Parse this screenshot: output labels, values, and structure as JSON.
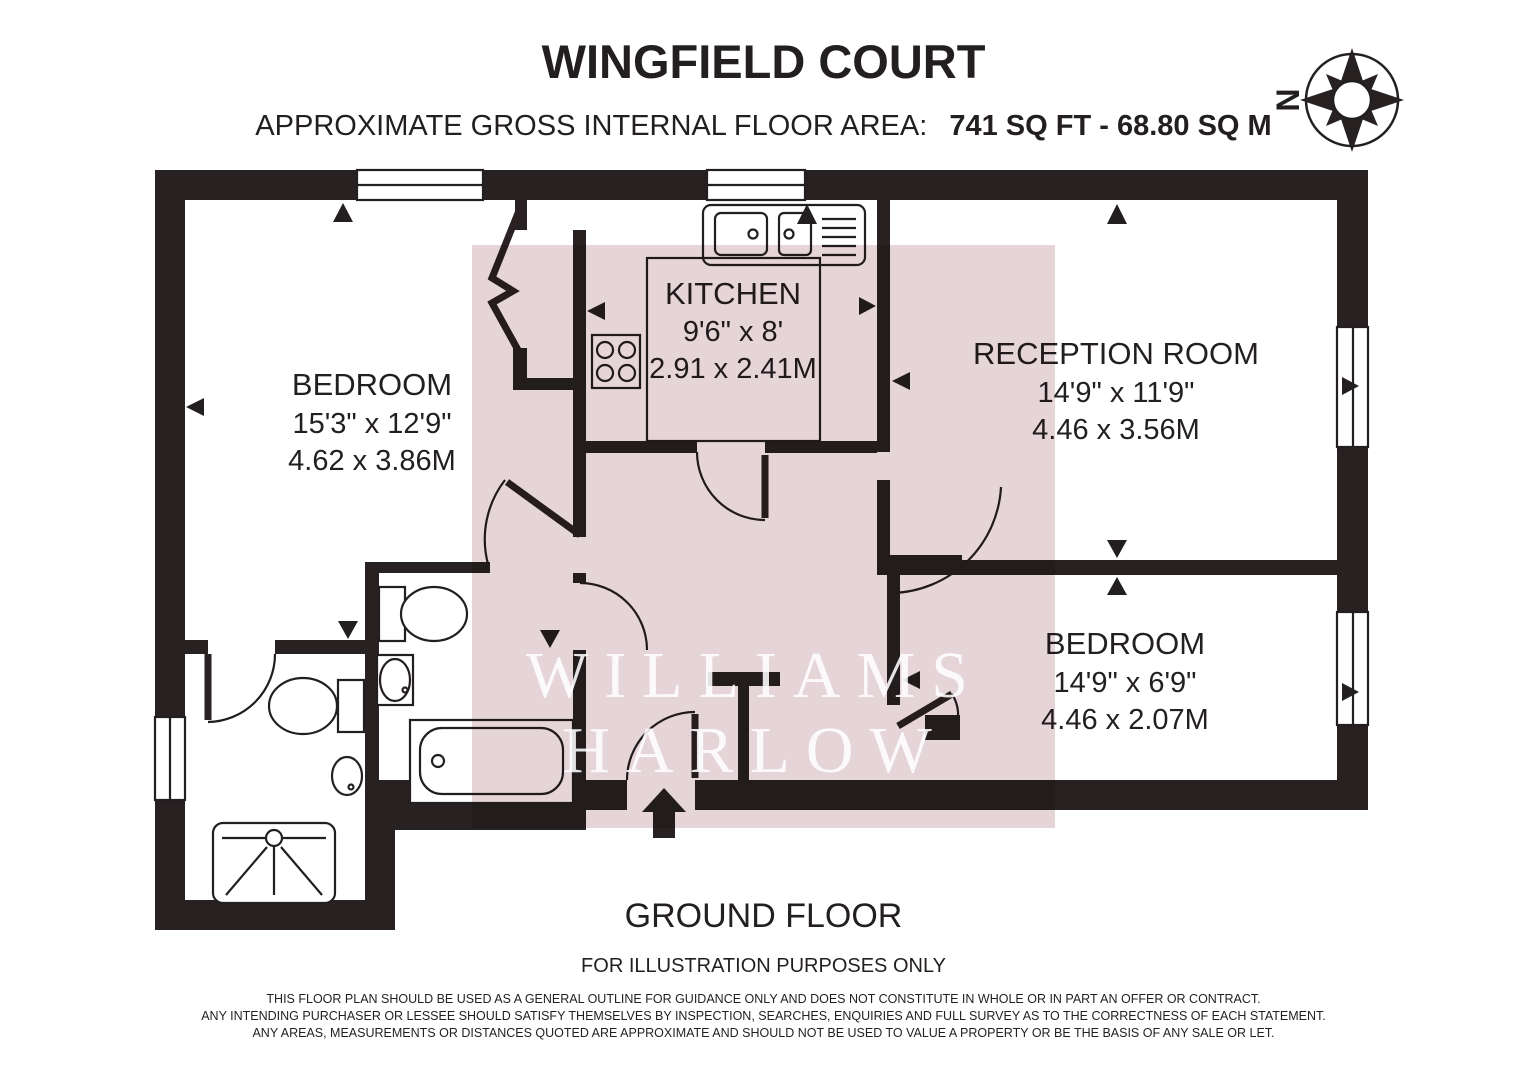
{
  "header": {
    "title": "WINGFIELD COURT",
    "area_label": "APPROXIMATE GROSS INTERNAL FLOOR AREA:",
    "area_value": "741 SQ FT - 68.80 SQ M"
  },
  "compass": {
    "north_label": "N"
  },
  "rooms": [
    {
      "id": "bedroom-1",
      "name": "BEDROOM",
      "dims_imperial": "15'3\" x 12'9\"",
      "dims_metric": "4.62 x 3.86M"
    },
    {
      "id": "kitchen",
      "name": "KITCHEN",
      "dims_imperial": "9'6\" x 8'",
      "dims_metric": "2.91 x 2.41M"
    },
    {
      "id": "reception-room",
      "name": "RECEPTION ROOM",
      "dims_imperial": "14'9\" x 11'9\"",
      "dims_metric": "4.46 x 3.56M"
    },
    {
      "id": "bedroom-2",
      "name": "BEDROOM",
      "dims_imperial": "14'9\" x 6'9\"",
      "dims_metric": "4.46 x 2.07M"
    }
  ],
  "watermark": {
    "line1": "WILLIAMS",
    "line2": "HARLOW"
  },
  "footer": {
    "floor_label": "GROUND FLOOR",
    "illustration_note": "FOR ILLUSTRATION PURPOSES ONLY",
    "disclaimer_lines": [
      "THIS FLOOR PLAN SHOULD BE USED AS A GENERAL OUTLINE FOR GUIDANCE ONLY AND DOES NOT CONSTITUTE IN WHOLE OR IN PART AN OFFER OR CONTRACT.",
      "ANY INTENDING PURCHASER OR LESSEE SHOULD SATISFY THEMSELVES BY INSPECTION, SEARCHES, ENQUIRIES AND FULL SURVEY AS TO THE CORRECTNESS OF EACH STATEMENT.",
      "ANY AREAS, MEASUREMENTS OR DISTANCES QUOTED ARE APPROXIMATE AND SHOULD NOT BE USED TO VALUE A PROPERTY OR BE THE BASIS OF ANY SALE OR LET."
    ]
  },
  "colors": {
    "wall": "#272122",
    "overlay_pink": "#e5d4d8",
    "text": "#231f20",
    "watermark": "#ffffff"
  }
}
